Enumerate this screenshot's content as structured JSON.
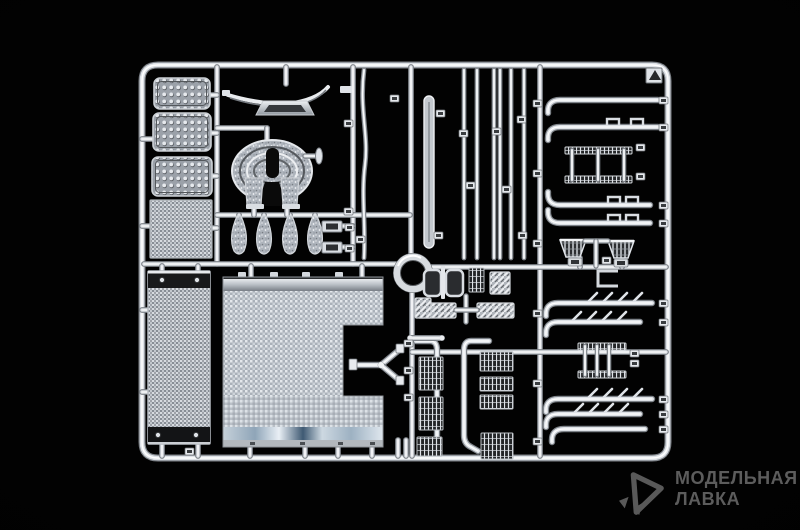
{
  "meta": {
    "background_color": "#000000",
    "chrome_color": "#dde1e6",
    "watermark_color": "#5c5c5c",
    "subject": "chrome-plated-model-kit-sprue"
  },
  "watermark": {
    "line1": "МОДЕЛЬНАЯ",
    "line2": "ЛАВКА",
    "icon": "paper-dart-logo-icon"
  },
  "sprue": {
    "frame": {
      "x": 142,
      "y": 65,
      "w": 526,
      "h": 393,
      "r": 16
    },
    "rails": [
      [
        217,
        67,
        217,
        264
      ],
      [
        353,
        67,
        353,
        264
      ],
      [
        411,
        67,
        411,
        257
      ],
      [
        412,
        290,
        412,
        456
      ],
      [
        540,
        67,
        540,
        456
      ],
      [
        144,
        264,
        396,
        264
      ],
      [
        430,
        267,
        666,
        267
      ],
      [
        217,
        215,
        410,
        215
      ],
      [
        412,
        352,
        666,
        352
      ],
      [
        217,
        128,
        267,
        128
      ],
      [
        267,
        128,
        267,
        142
      ],
      [
        286,
        67,
        286,
        84
      ],
      [
        251,
        266,
        251,
        278
      ],
      [
        362,
        266,
        362,
        278
      ],
      [
        250,
        446,
        250,
        456
      ],
      [
        305,
        446,
        305,
        456
      ],
      [
        338,
        446,
        338,
        456
      ],
      [
        372,
        446,
        372,
        456
      ],
      [
        398,
        440,
        398,
        456
      ],
      [
        406,
        440,
        406,
        456
      ],
      [
        162,
        266,
        162,
        272
      ],
      [
        198,
        266,
        198,
        272
      ],
      [
        162,
        444,
        162,
        456
      ],
      [
        198,
        444,
        198,
        456
      ],
      [
        142,
        139,
        153,
        139
      ],
      [
        142,
        226,
        150,
        226
      ],
      [
        142,
        310,
        148,
        310
      ],
      [
        142,
        392,
        148,
        392
      ],
      [
        210,
        95,
        217,
        95
      ],
      [
        211,
        133,
        217,
        133
      ],
      [
        212,
        176,
        217,
        176
      ],
      [
        212,
        228,
        217,
        228
      ],
      [
        239,
        215,
        239,
        221
      ],
      [
        264,
        215,
        264,
        221
      ],
      [
        290,
        215,
        290,
        221
      ],
      [
        315,
        215,
        315,
        221
      ],
      [
        254,
        206,
        254,
        215
      ],
      [
        287,
        206,
        287,
        215
      ],
      [
        342,
        226,
        353,
        226
      ],
      [
        342,
        247,
        353,
        247
      ],
      [
        580,
        258,
        580,
        267
      ],
      [
        622,
        258,
        622,
        267
      ]
    ],
    "parts": [
      {
        "t": "plate",
        "name": "tread-plate-1",
        "x": 154,
        "y": 78,
        "w": 56,
        "h": 31
      },
      {
        "t": "plate",
        "name": "tread-plate-2",
        "x": 153,
        "y": 113,
        "w": 58,
        "h": 38
      },
      {
        "t": "plate",
        "name": "tread-plate-3",
        "x": 152,
        "y": 157,
        "w": 60,
        "h": 39
      },
      {
        "t": "mesh",
        "name": "radiator-grille-mesh",
        "x": 150,
        "y": 200,
        "w": 62,
        "h": 58
      },
      {
        "t": "panel",
        "name": "side-fairing-panel",
        "x": 148,
        "y": 271,
        "w": 62,
        "h": 173
      },
      {
        "t": "deck",
        "name": "catwalk-deck-plate"
      },
      {
        "t": "wing",
        "name": "roof-wind-deflector"
      },
      {
        "t": "fifthwheel",
        "name": "fifth-wheel-coupling"
      },
      {
        "t": "pin",
        "name": "kingpin-release-handle"
      },
      {
        "t": "teardrop",
        "name": "mudflap-1",
        "cx": 239
      },
      {
        "t": "teardrop",
        "name": "mudflap-2",
        "cx": 264
      },
      {
        "t": "teardrop",
        "name": "mudflap-3",
        "cx": 290
      },
      {
        "t": "teardrop",
        "name": "mudflap-4",
        "cx": 315
      },
      {
        "t": "padrect",
        "name": "chrome-pad-1",
        "x": 322,
        "y": 221,
        "w": 20,
        "h": 11
      },
      {
        "t": "padrect",
        "name": "chrome-pad-2",
        "x": 322,
        "y": 242,
        "w": 20,
        "h": 11
      },
      {
        "t": "ring",
        "name": "air-cleaner-ring",
        "cx": 413,
        "cy": 273
      },
      {
        "t": "rod",
        "name": "curved-grab-rail",
        "x": 364,
        "curve": true
      },
      {
        "t": "flatbar",
        "name": "trim-strip"
      },
      {
        "t": "rod",
        "name": "exhaust-rod-1",
        "x": 464
      },
      {
        "t": "rod",
        "name": "exhaust-rod-2",
        "x": 477
      },
      {
        "t": "rod",
        "name": "exhaust-rod-3",
        "x": 494
      },
      {
        "t": "rod",
        "name": "exhaust-rod-4",
        "x": 500
      },
      {
        "t": "rod",
        "name": "exhaust-rod-5",
        "x": 511
      },
      {
        "t": "rod",
        "name": "exhaust-rod-6",
        "x": 524
      },
      {
        "t": "pipe",
        "name": "exhaust-pipe-1",
        "y": 100,
        "x1": 552,
        "x2": 658,
        "hook": "down"
      },
      {
        "t": "pipe",
        "name": "exhaust-pipe-2",
        "y": 127,
        "x1": 552,
        "x2": 658,
        "hook": "down",
        "clamps": [
          613,
          637
        ]
      },
      {
        "t": "ladder",
        "name": "entry-step-1",
        "x": 565,
        "w": 67,
        "y1": 147,
        "y2": 176,
        "cols": [
          572,
          598,
          624
        ]
      },
      {
        "t": "pipe",
        "name": "exhaust-pipe-3",
        "y": 205,
        "x1": 552,
        "x2": 650,
        "hook": "up",
        "clamps": [
          614,
          632
        ]
      },
      {
        "t": "pipe",
        "name": "exhaust-pipe-4",
        "y": 223,
        "x1": 552,
        "x2": 650,
        "hook": "up",
        "clamps": [
          614,
          632
        ]
      },
      {
        "t": "horn",
        "name": "air-horn-1",
        "pts": "560,240 586,240 580,257 566,257",
        "foot": [
          568,
          258
        ]
      },
      {
        "t": "horn",
        "name": "air-horn-2",
        "pts": "608,241 634,241 628,258 614,258",
        "foot": [
          614,
          259
        ]
      },
      {
        "t": "tpiece",
        "name": "horn-connector"
      },
      {
        "t": "bracket",
        "name": "mounting-bracket"
      },
      {
        "t": "pipe",
        "name": "heat-shield-pipe-1",
        "y": 303,
        "x1": 550,
        "x2": 652,
        "hook": "down",
        "teeth": [
          589,
          604,
          619,
          634
        ]
      },
      {
        "t": "pipe",
        "name": "heat-shield-pipe-2",
        "y": 322,
        "x1": 550,
        "x2": 640,
        "hook": "down",
        "teeth": [
          573,
          588,
          603,
          618
        ]
      },
      {
        "t": "ladder",
        "name": "entry-step-2",
        "x": 578,
        "w": 48,
        "y1": 343,
        "y2": 371,
        "cols": [
          585,
          597,
          609
        ]
      },
      {
        "t": "pipe",
        "name": "heat-shield-pipe-3",
        "y": 399,
        "x1": 550,
        "x2": 652,
        "hook": "down",
        "teeth": [
          589,
          604,
          619,
          634
        ]
      },
      {
        "t": "pipe",
        "name": "heat-shield-pipe-4",
        "y": 414,
        "x1": 550,
        "x2": 640,
        "hook": "down",
        "teeth": [
          575,
          590,
          605,
          620
        ]
      },
      {
        "t": "pipe",
        "name": "exhaust-pipe-5",
        "y": 429,
        "x1": 556,
        "x2": 645,
        "hook": "down"
      },
      {
        "t": "cushions",
        "name": "seat-cushion-pair"
      },
      {
        "t": "gridpad",
        "name": "mesh-step-1",
        "x": 469,
        "y": 268,
        "w": 15,
        "h": 24
      },
      {
        "t": "hatchpad",
        "name": "textured-pad-1",
        "x": 490,
        "y": 272,
        "w": 20,
        "h": 22
      },
      {
        "t": "hatchpad",
        "name": "tread-step-left",
        "x": 418,
        "y": 303,
        "w": 38,
        "h": 15
      },
      {
        "t": "hatchpad",
        "name": "tread-step-right",
        "x": 477,
        "y": 303,
        "w": 37,
        "h": 15
      },
      {
        "t": "tpiece2",
        "name": "step-connector"
      },
      {
        "t": "handrail",
        "name": "grab-handrail-left",
        "d": "M416,341 L430,341 Q437,341 437,350 L437,435 Q437,444 430,447 L423,451"
      },
      {
        "t": "handrail",
        "name": "grab-handrail-right",
        "d": "M489,341 L471,341 Q464,341 464,350 L464,435 Q464,444 471,447 L478,451"
      },
      {
        "t": "gridpad",
        "name": "mesh-step-2",
        "x": 419,
        "y": 357,
        "w": 24,
        "h": 33
      },
      {
        "t": "gridpad",
        "name": "mesh-step-3",
        "x": 419,
        "y": 397,
        "w": 24,
        "h": 33
      },
      {
        "t": "gridpad",
        "name": "mesh-step-4",
        "x": 417,
        "y": 437,
        "w": 25,
        "h": 19
      },
      {
        "t": "gridpad",
        "name": "mesh-step-5",
        "x": 480,
        "y": 352,
        "w": 33,
        "h": 19
      },
      {
        "t": "gridpad",
        "name": "mesh-step-6",
        "x": 480,
        "y": 377,
        "w": 33,
        "h": 14
      },
      {
        "t": "gridpad",
        "name": "mesh-step-7",
        "x": 480,
        "y": 395,
        "w": 33,
        "h": 14
      },
      {
        "t": "gridpad",
        "name": "mesh-step-8",
        "x": 481,
        "y": 433,
        "w": 32,
        "h": 26
      },
      {
        "t": "hatchpad",
        "name": "textured-pad-2",
        "x": 415,
        "y": 298,
        "w": 16,
        "h": 20
      },
      {
        "t": "rodH",
        "name": "linkage-rod"
      },
      {
        "t": "fork",
        "name": "three-way-hose-fork"
      },
      {
        "t": "cornertag",
        "name": "sprue-letter-tag"
      }
    ],
    "gate_tags": [
      [
        390,
        95
      ],
      [
        436,
        110
      ],
      [
        459,
        130
      ],
      [
        492,
        128
      ],
      [
        517,
        116
      ],
      [
        466,
        182
      ],
      [
        502,
        186
      ],
      [
        434,
        232
      ],
      [
        518,
        232
      ],
      [
        356,
        236
      ],
      [
        344,
        120
      ],
      [
        344,
        208
      ],
      [
        404,
        340
      ],
      [
        404,
        367
      ],
      [
        404,
        394
      ],
      [
        533,
        100
      ],
      [
        533,
        170
      ],
      [
        533,
        240
      ],
      [
        533,
        310
      ],
      [
        533,
        380
      ],
      [
        533,
        438
      ],
      [
        659,
        97
      ],
      [
        659,
        124
      ],
      [
        659,
        202
      ],
      [
        659,
        220
      ],
      [
        659,
        300
      ],
      [
        659,
        319
      ],
      [
        659,
        396
      ],
      [
        659,
        411
      ],
      [
        659,
        426
      ],
      [
        636,
        144
      ],
      [
        636,
        173
      ],
      [
        630,
        350
      ],
      [
        630,
        360
      ],
      [
        602,
        257
      ],
      [
        185,
        448
      ],
      [
        345,
        224
      ],
      [
        345,
        245
      ]
    ]
  }
}
